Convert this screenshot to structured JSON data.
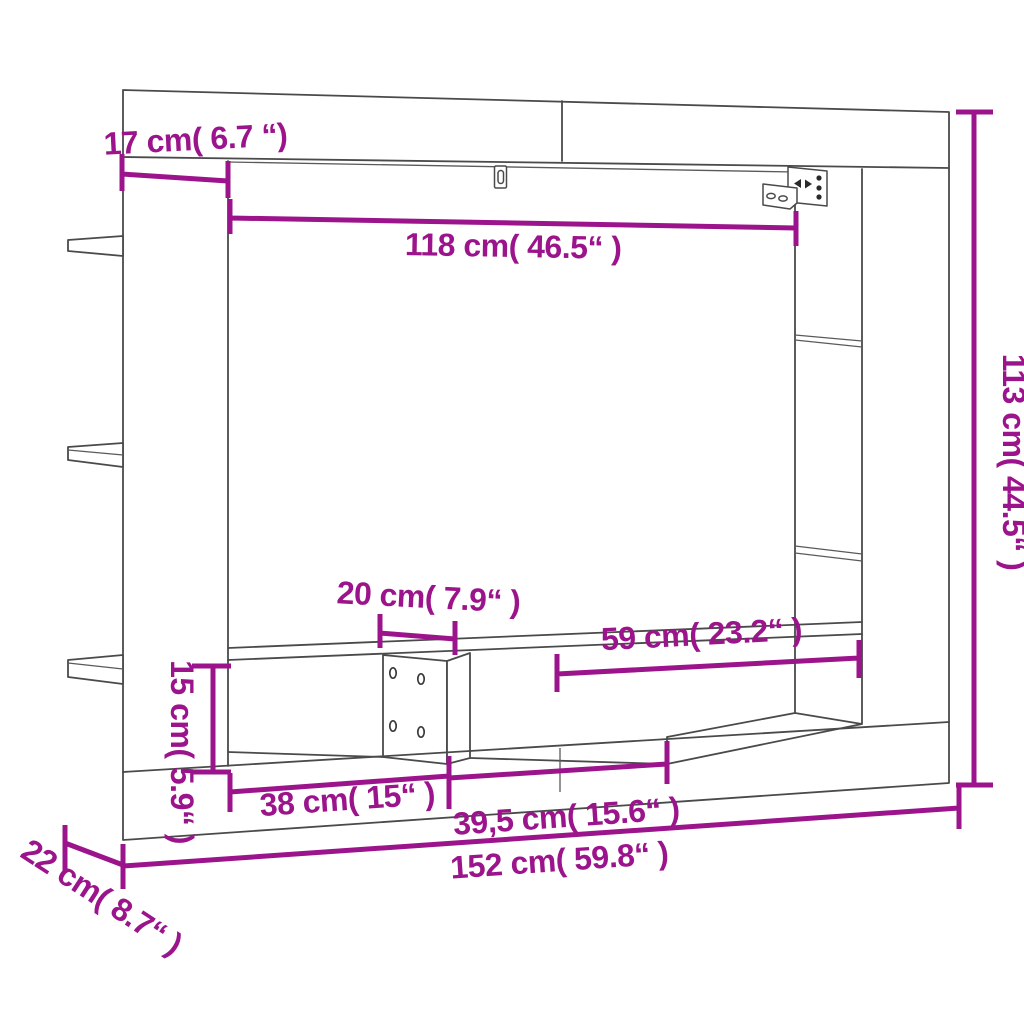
{
  "page": {
    "background": "#ffffff"
  },
  "diagram": {
    "title": "TV wall cabinet dimension diagram",
    "accent_color": "#9b148b",
    "outline_color": "#4a4a4a",
    "hardware_icons": [
      "keyhole-slot",
      "wall-mount-bracket"
    ],
    "dimensions": {
      "top_depth": "17 cm( 6.7 “)",
      "inner_width": "118 cm( 46.5“ )",
      "total_height": "113 cm( 44.5“ )",
      "shelf_gap_width": "20 cm( 7.9“ )",
      "right_shelf_width": "59 cm( 23.2“ )",
      "lower_shelf_height": "15 cm( 5.9“ )",
      "left_compartment_width": "38 cm( 15“ )",
      "middle_compartment_width": "39,5 cm( 15.6“ )",
      "total_width": "152 cm( 59.8“ )",
      "side_depth": "22 cm( 8.7“ )"
    }
  }
}
